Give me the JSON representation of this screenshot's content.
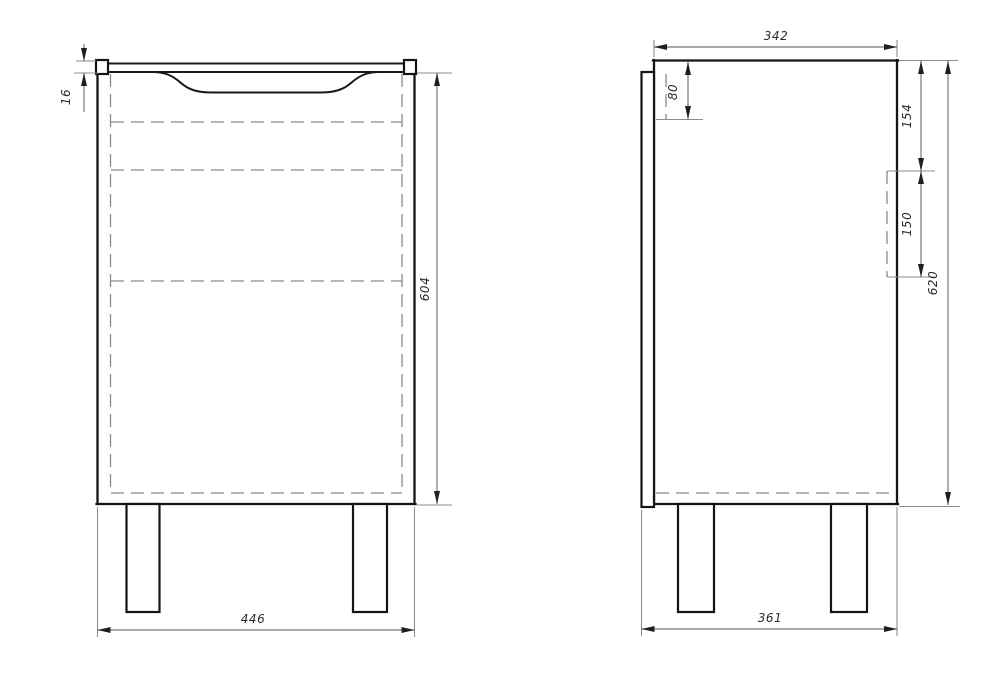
{
  "drawing": {
    "type": "cabinet-orthographic-views",
    "views": {
      "front": {
        "label": "front-view",
        "dims": {
          "width": "446",
          "height": "604",
          "top_panel_thickness": "16"
        }
      },
      "side": {
        "label": "side-view",
        "dims": {
          "depth": "342",
          "handle_groove_height": "80",
          "cutout_top_offset": "154",
          "cutout_height": "150",
          "body_height": "620",
          "total_depth": "361"
        }
      }
    },
    "line_colors": {
      "outline": "#141414",
      "dimension": "#777777",
      "hidden": "#8a8a8a",
      "background": "#ffffff"
    }
  }
}
